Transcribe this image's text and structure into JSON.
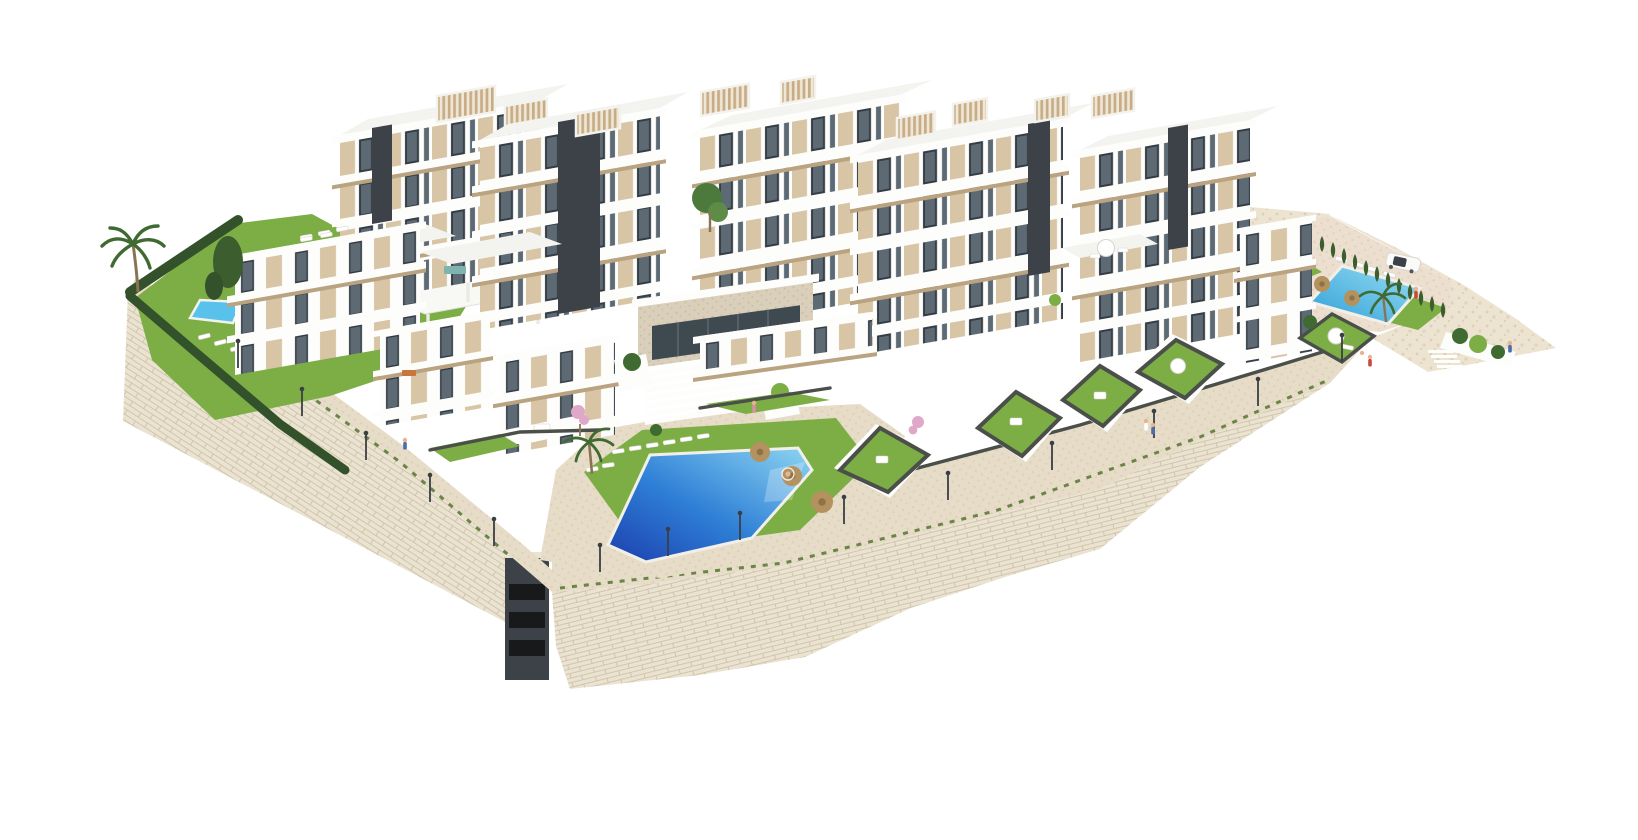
{
  "meta": {
    "title": "Aerial 3D architectural render of a white hillside residential complex",
    "description": "Isometric aerial rendering of a modern white apartment complex built on a beige stone retaining wall terrace, with a large central swimming pool, two smaller community pools, private walled lawns, rooftop pergolas, cypress hedges, palm trees, street lamps, a few people and one parked car. Pure image, no text or UI elements.",
    "width": 1638,
    "height": 840,
    "background": "#ffffff"
  },
  "palette": {
    "bg": "#ffffff",
    "white": "#fdfdfc",
    "roof": "#f3f3f0",
    "shade": "#e9e9e5",
    "slab-shadow": "#cfc9bd",
    "beige": "#d8c5a6",
    "beige-dark": "#b9a381",
    "win-frame": "#343c44",
    "glass": "#5d6a74",
    "glass-dark": "#3f4a50",
    "core": "#3c4248",
    "slat": "#c7ad87",
    "slat-gap": "#efe6d6",
    "stone": "#eae3d2",
    "stone-line": "#cbbc9f",
    "pave": "#e6dcc7",
    "pave-dot": "#d2c4a8",
    "pave-right": "#ecdfcf",
    "rock": "#ede3d1",
    "rock-dot": "#d8c9b1",
    "lawn": "#7cae45",
    "lawn-light": "#9cc763",
    "hedge": "#33512a",
    "cypress": "#3c5e2f",
    "tuft": "#5d7a3a",
    "frond": "#3f6b33",
    "trunk": "#8a7354",
    "blossom": "#dfa8c8",
    "pool-deep": "#1c3fae",
    "pool-mid": "#2e7fd6",
    "pool-light": "#8ed5f2",
    "pool-small": "#59c2ec",
    "pool-r1": "#2f9fd8",
    "pool-r2": "#9adef2",
    "umbrella": "#b4925f",
    "umbrella-dark": "#8f7248",
    "fence": "#4a4f4a",
    "lamp": "#3a3f44",
    "car-body": "#fafaf8",
    "car-glass": "#3a4248",
    "skin": "#e8b48f",
    "person-red": "#c84a3a",
    "person-blue": "#4a6fa8",
    "person-pink": "#d98fa6",
    "teal-furniture": "#7fb3ad",
    "patio-orange": "#c8763a"
  },
  "scene": {
    "subject": "Modern white residential complex on stone-clad hillside terrace, aerial 3D render on white background",
    "elements": {
      "building_blocks": 11,
      "swimming_pools": 3,
      "walled_private_gardens": 5,
      "roof_pergolas": 9,
      "street_lamps": 14,
      "palm_trees": 3,
      "cypress_trees": 12,
      "straw_umbrellas": 5,
      "white_umbrellas": 2,
      "sun_loungers": 20,
      "cars": 1,
      "people": 9
    }
  }
}
